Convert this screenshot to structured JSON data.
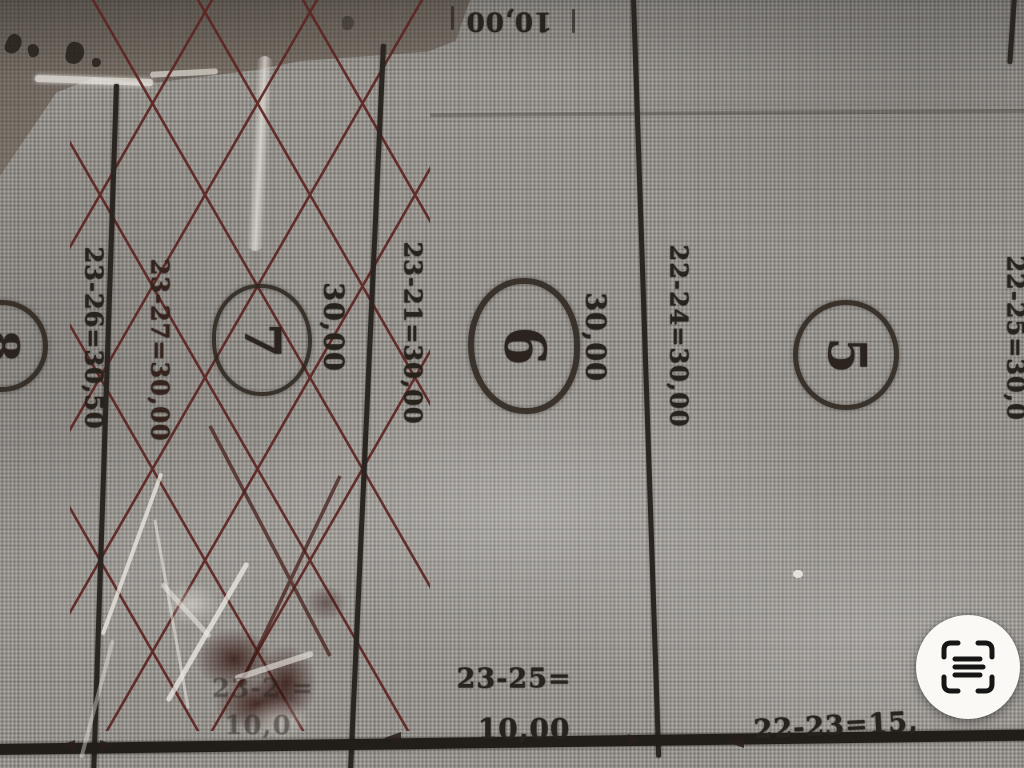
{
  "map": {
    "lots": {
      "lot8": {
        "number": "8"
      },
      "lot7": {
        "number": "7",
        "width_label": "30,00"
      },
      "lot6": {
        "number": "6",
        "width_label": "30,00"
      },
      "lot5": {
        "number": "5"
      }
    },
    "boundary_labels": {
      "left_outer": "23-26=30,50",
      "left_inner": "23-27=30,00",
      "between_7_6": "23-21=30,00",
      "between_6_5": "22-24=30,00",
      "right_edge_partial": "22-25=30,0"
    },
    "top_labels": {
      "street_dim": "10,00"
    },
    "bottom_labels": {
      "center_segment": "23-25=",
      "center_value": "10,00",
      "right_segment": "22-23=15,",
      "left_segment_faded": "23-2 =",
      "left_value_faded": "10,0"
    }
  },
  "viewer": {
    "scan_button_icon": "text-scan-icon"
  },
  "colors": {
    "paper": "#95918b",
    "ink": "#28221c",
    "hatch_red": "#5d2522",
    "button_bg": "#faf9f6"
  }
}
